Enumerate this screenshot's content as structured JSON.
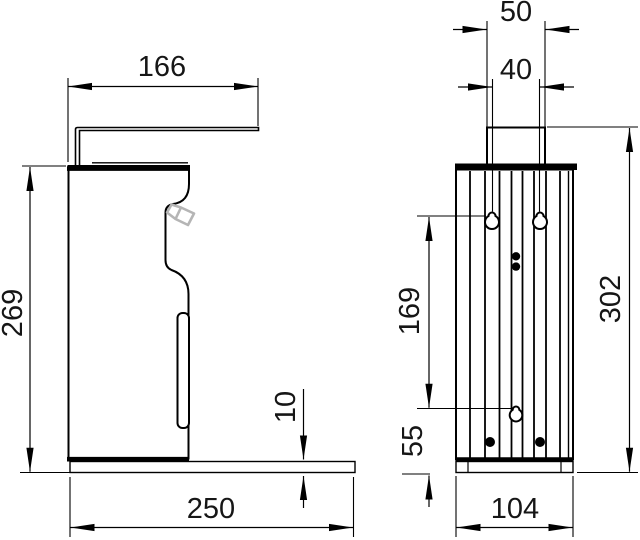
{
  "drawing": {
    "views": {
      "side_view": "dispenser-side-view",
      "front_view": "dispenser-front-view"
    },
    "dims": {
      "arm_length": "166",
      "body_height": "269",
      "base_depth": "250",
      "base_thickness": "10",
      "bracket_width": "50",
      "hole_spacing_x": "40",
      "hole_spacing_y": "169",
      "hole_to_base": "55",
      "total_height": "302",
      "body_width": "104"
    },
    "colors": {
      "line": "#000000",
      "text": "#161616",
      "spout_gray": "#b5b5b5",
      "background": "#ffffff"
    }
  }
}
